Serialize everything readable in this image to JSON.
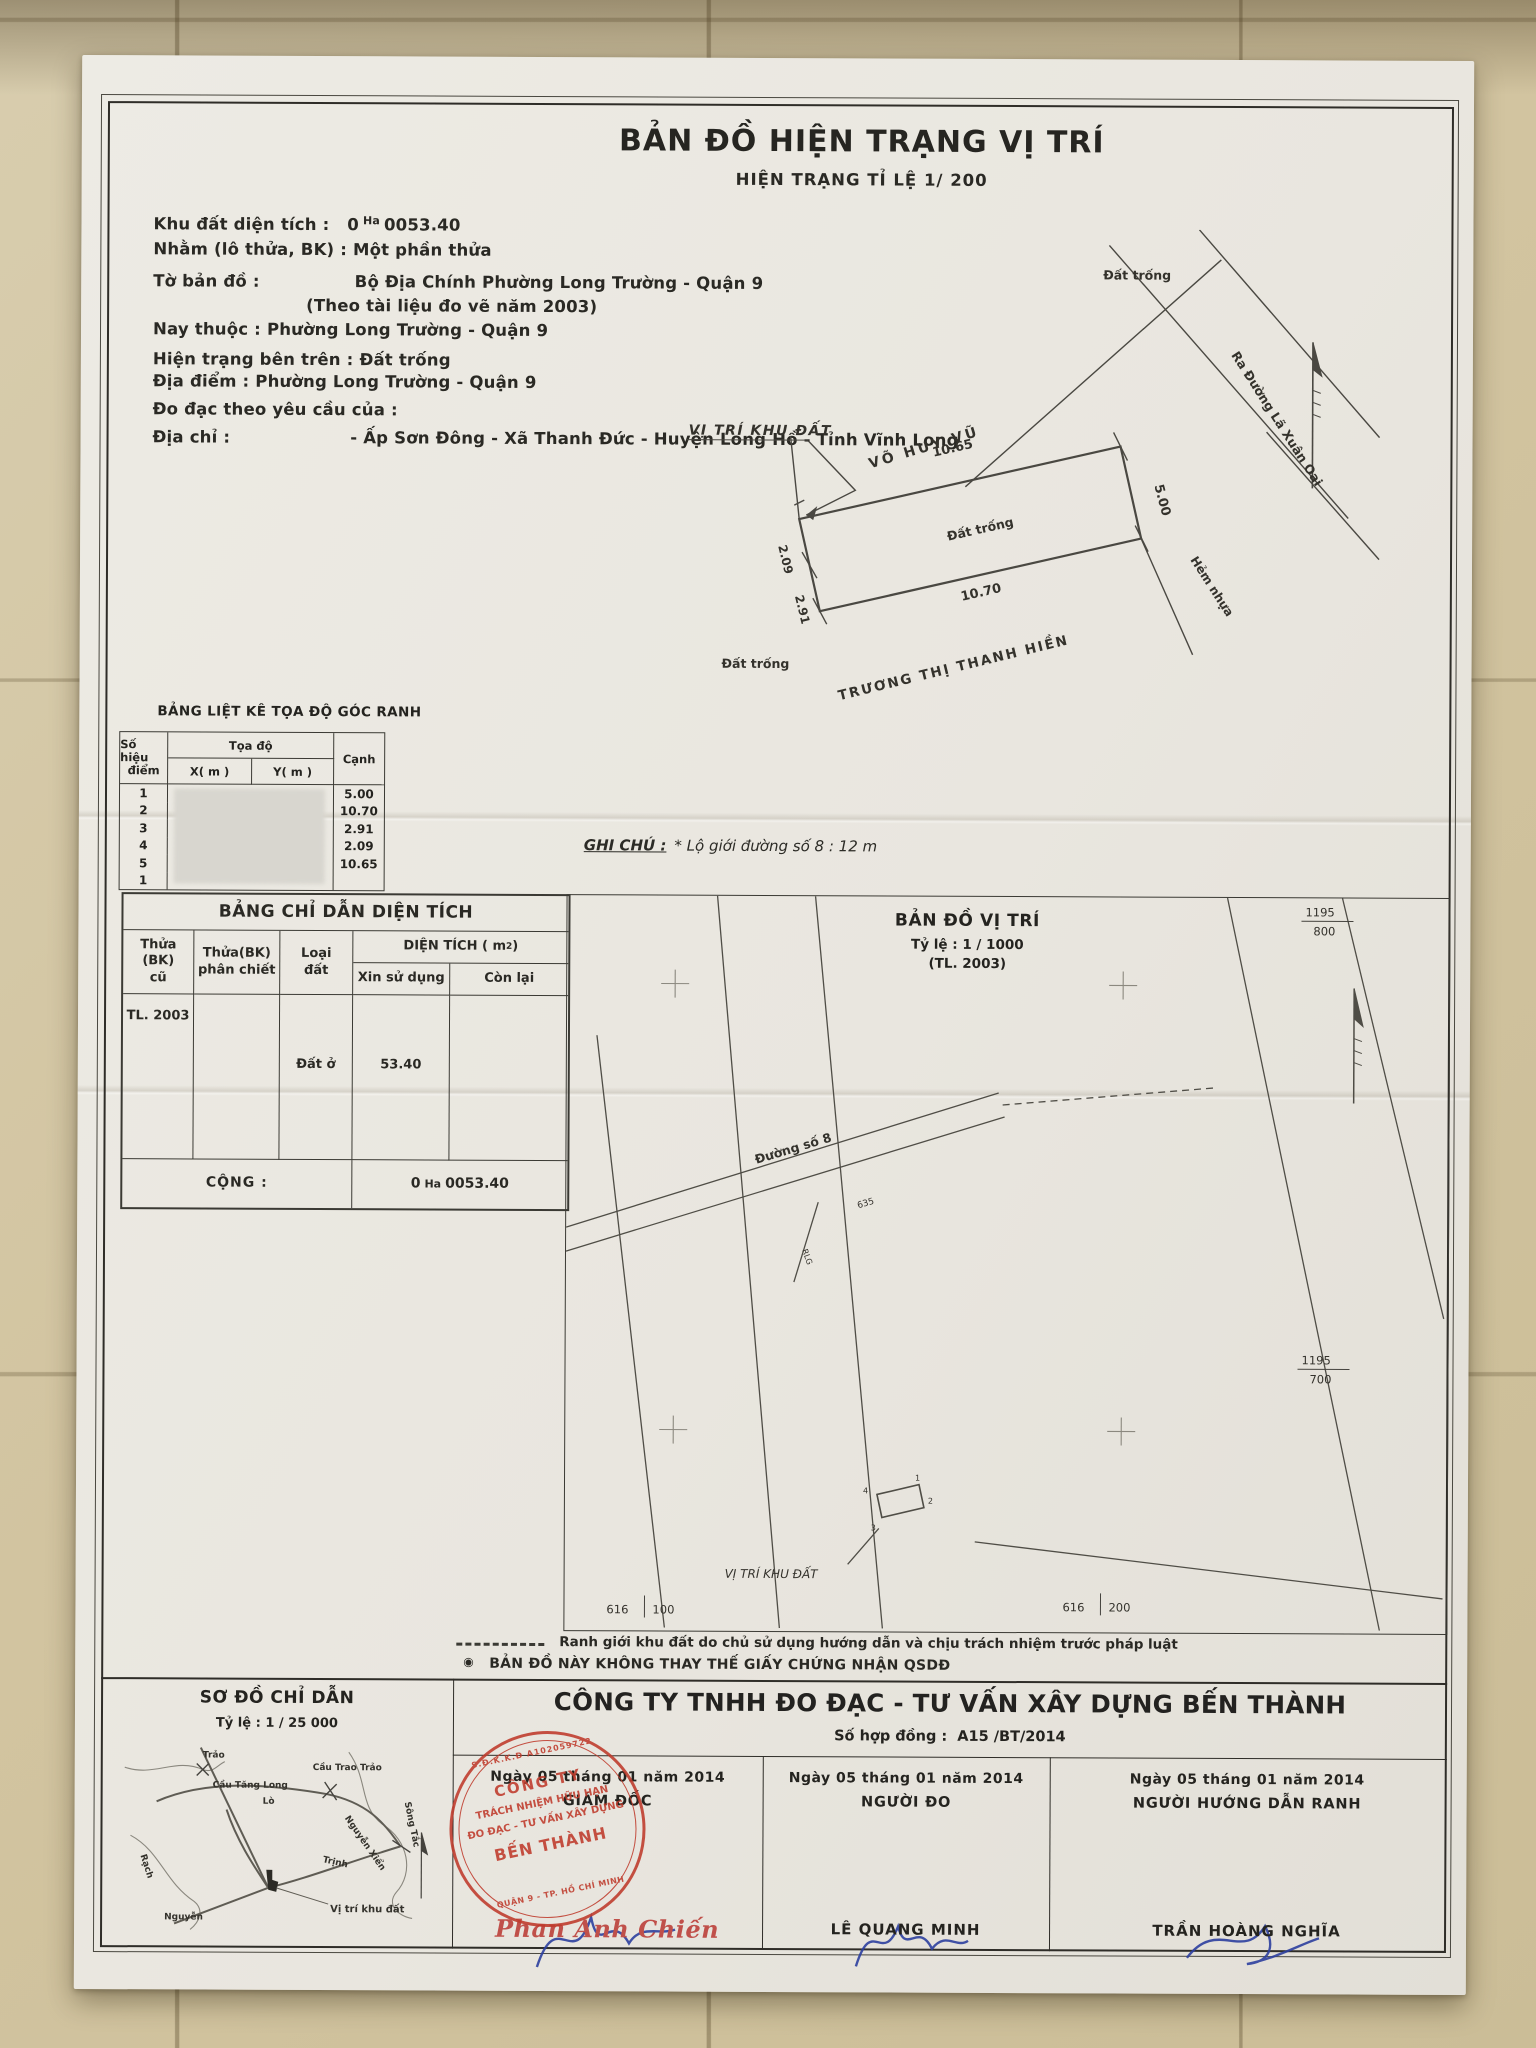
{
  "title": {
    "main": "BẢN ĐỒ HIỆN TRẠNG VỊ TRÍ",
    "sub": "HIỆN TRẠNG TỈ LỆ 1/ 200"
  },
  "info": {
    "area_label": "Khu đất diện tích :",
    "area_prefix": "0",
    "area_unit": "Ha",
    "area_value": "0053.40",
    "lot_label": "Nhằm (lô thửa, BK) :",
    "lot_value": "Một phần thửa",
    "sheet_label": "Tờ bản đồ :",
    "sheet_value": "Bộ Địa Chính Phường Long Trường - Quận 9",
    "sheet_note": "(Theo tài liệu đo vẽ năm 2003)",
    "now_label": "Nay thuộc :",
    "now_value": "Phường Long Trường - Quận 9",
    "status_label": "Hiện trạng bên trên :",
    "status_value": "Đất trống",
    "place_label": "Địa điểm :",
    "place_value": "Phường Long Trường - Quận 9",
    "request_label": "Đo đạc theo yêu cầu của :",
    "addr_label": "Địa chỉ :",
    "addr_value": "- Ấp Sơn Đông - Xã Thanh Đức - Huyện Long Hồ - Tỉnh Vĩnh Long"
  },
  "site_plan": {
    "pointer_label": "VỊ TRÍ KHU ĐẤT",
    "owner_top": "VÕ HUY VŨ",
    "owner_bottom": "TRƯƠNG THỊ THANH HIỀN",
    "road_label": "Ra Đường Lã Xuân Oai",
    "alley_label": "Hẻm nhựa",
    "empty": "Đất trống",
    "dims": {
      "top": "10.65",
      "right": "5.00",
      "bottom": "10.70",
      "left_upper": "2.09",
      "left_lower": "2.91"
    }
  },
  "coord_table": {
    "title": "BẢNG LIỆT KÊ TỌA ĐỘ GÓC RANH",
    "col_point_1": "Số hiệu",
    "col_point_2": "điểm",
    "col_coord": "Tọa độ",
    "col_x": "X( m )",
    "col_y": "Y( m )",
    "col_edge": "Cạnh",
    "rows": [
      {
        "p": "1",
        "c": "5.00"
      },
      {
        "p": "2",
        "c": "10.70"
      },
      {
        "p": "3",
        "c": "2.91"
      },
      {
        "p": "4",
        "c": "2.09"
      },
      {
        "p": "5",
        "c": "10.65"
      },
      {
        "p": "1",
        "c": ""
      }
    ]
  },
  "note": {
    "label": "GHI CHÚ :",
    "text": "* Lộ giới đường số 8 :  12 m"
  },
  "area_table": {
    "title": "BẢNG CHỈ DẪN DIỆN TÍCH",
    "col_old_1": "Thửa (BK)",
    "col_old_2": "cũ",
    "col_split_1": "Thửa(BK)",
    "col_split_2": "phân chiết",
    "col_type_1": "Loại",
    "col_type_2": "đất",
    "col_area_pre": "DIỆN TÍCH ( m",
    "col_area_sup": "2",
    "col_area_post": " )",
    "col_use": "Xin sử dụng",
    "col_left": "Còn lại",
    "row_old": "TL. 2003",
    "row_type": "Đất ở",
    "row_use": "53.40",
    "total_label": "CỘNG :",
    "total_prefix": "0",
    "total_unit": "Ha",
    "total_value": "0053.40"
  },
  "location_map": {
    "title": "BẢN ĐỒ VỊ TRÍ",
    "scale": "Tỷ lệ  :  1 / 1000",
    "source": "(TL. 2003)",
    "road": "Đường số 8",
    "road_note": "635",
    "rlg": "RLG",
    "pointer": "VỊ TRÍ KHU ĐẤT",
    "grid": {
      "tr_n": "1195",
      "tr_d": "800",
      "r_n": "1195",
      "r_d": "700",
      "bl_a": "616",
      "bl_b": "100",
      "br_a": "616",
      "br_b": "200"
    },
    "n1": "1",
    "n2": "2",
    "n3": "3",
    "n4": "4"
  },
  "legend": {
    "bullet": "◉",
    "line1": "Ranh giới khu đất do chủ sử dụng hướng dẫn và chịu trách nhiệm trước pháp luật",
    "line2": "BẢN ĐỒ NÀY KHÔNG THAY THẾ GIẤY CHỨNG NHẬN QSDĐ"
  },
  "sketch": {
    "title": "SƠ ĐỒ CHỈ DẪN",
    "scale": "Tỷ lệ  :  1 /  25 000",
    "pointer": "Vị trí khu đất",
    "labels": {
      "l1": "Cầu Tăng Long",
      "l2": "Cầu Trao Trảo",
      "l3": "Trảo",
      "l4": "Sông Tắc",
      "l5": "Nguyễn Xiển",
      "l6": "Rạch",
      "l7": "Nguyễn",
      "l8": "Trịnh",
      "l9": "Lò"
    }
  },
  "footer": {
    "company": "CÔNG TY TNHH ĐO ĐẠC - TƯ VẤN XÂY DỰNG BẾN THÀNH",
    "contract_label": "Số hợp đồng :",
    "contract_no": "A15  /BT/2014",
    "cols": [
      {
        "date": "Ngày  05  tháng  01  năm 2014",
        "role": "GIÁM ĐỐC",
        "name": "Phan Anh Chiến"
      },
      {
        "date": "Ngày  05  tháng  01  năm 2014",
        "role": "NGƯỜI ĐO",
        "name": "LÊ QUANG MINH"
      },
      {
        "date": "Ngày  05  tháng  01  năm 2014",
        "role": "NGƯỜI HƯỚNG DẪN RANH",
        "name": "TRẦN HOÀNG NGHĨA"
      }
    ],
    "stamp": {
      "arc": "S.Đ.K.K.Đ A102059722",
      "l1": "CÔNG TY",
      "l2": "TRÁCH NHIỆM HỮU HẠN",
      "l3": "ĐO ĐẠC - TƯ VẤN XÂY DỰNG",
      "l4": "BẾN THÀNH",
      "l5": "QUẬN 9 - TP. HỒ CHÍ MINH"
    }
  },
  "colors": {
    "stamp_red": "#bf3a2b",
    "signature_blue": "#2c3f9e",
    "name_red": "#c0504a"
  }
}
